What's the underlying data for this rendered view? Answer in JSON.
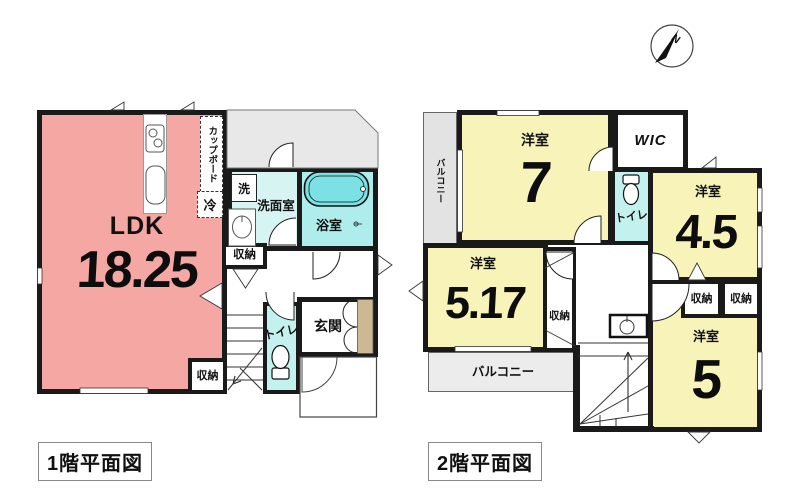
{
  "palette": {
    "ldk_pink": "#F5A7A3",
    "room_yellow": "#F8F4B9",
    "washroom_cyan": "#D6F5F2",
    "toilet_cyan": "#C2F1EE",
    "bath_cyan": "#AEEDEB",
    "tub_cyan": "#7CE1E4",
    "gray_area": "#E8E8E8",
    "balcony_gray": "#E3E3E3",
    "balcony_light": "#ECECEC",
    "door_tan": "#CDB896",
    "wall": "#1A1A1A"
  },
  "compass": {
    "north_label": "N"
  },
  "floor1": {
    "title": "1階平面図",
    "ldk_label": "LDK",
    "ldk_size": "18.25",
    "cupboard": "カップボード",
    "fridge": "冷",
    "washer": "洗",
    "washroom": "洗面室",
    "bathroom": "浴室",
    "storage_hall": "収納",
    "storage_ldk": "収納",
    "toilet": "トイレ",
    "entrance": "玄関",
    "porch": "ポーチ"
  },
  "floor2": {
    "title": "2階平面図",
    "balcony_left": "バルコニー",
    "balcony_bottom": "バルコニー",
    "room7_label": "洋室",
    "room7_size": "7",
    "wic": "WIC",
    "toilet": "トイレ",
    "room45_label": "洋室",
    "room45_size": "4.5",
    "room5_label": "洋室",
    "room5_size": "5",
    "room517_label": "洋室",
    "room517_size": "5.17",
    "storage_a": "収納",
    "storage_b": "収納",
    "storage_c": "収納"
  }
}
